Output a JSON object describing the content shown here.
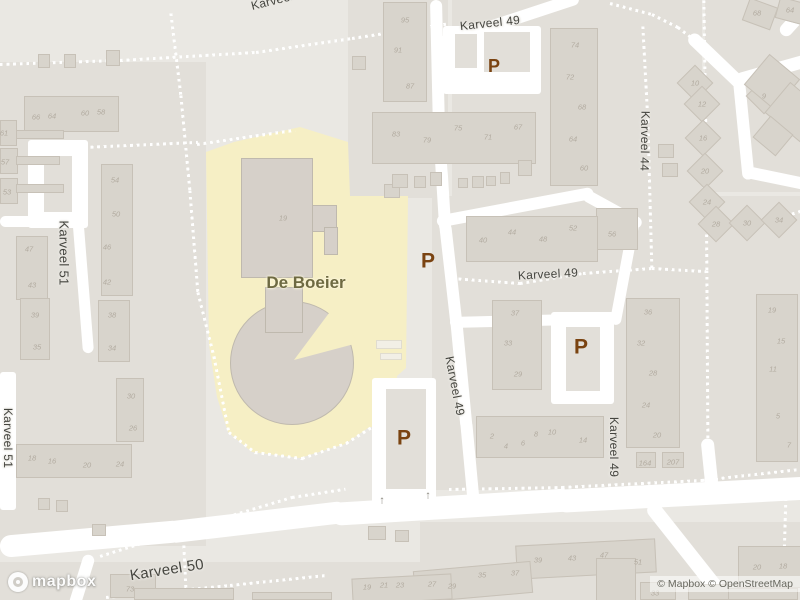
{
  "colors": {
    "base": "#eae8e3",
    "block": "#e2dfd9",
    "road": "#ffffff",
    "building_fill": "#d8d4cc",
    "building_stroke": "#c7c1b7",
    "school_fill": "#d6d0c9",
    "school_stroke": "#bfb9ae",
    "school_ground": "#f6efc5",
    "house_number": "#b2aba0",
    "street_label": "#45453f",
    "parking": "#7a4311",
    "poi_label": "#6e6a42"
  },
  "map": {
    "blocks": [
      [
        0,
        62,
        206,
        484
      ],
      [
        348,
        0,
        100,
        198
      ],
      [
        452,
        0,
        250,
        196
      ],
      [
        432,
        196,
        368,
        294
      ],
      [
        705,
        0,
        95,
        192
      ],
      [
        0,
        562,
        424,
        38
      ],
      [
        420,
        522,
        380,
        78
      ]
    ],
    "yellow_polygon": "206,152 234,142 300,127 348,142 350,196 408,196 406,368 397,376 395,420 368,428 345,444 300,458 252,452 228,432 217,397 209,345",
    "road_rects": [
      [
        28,
        140,
        60,
        88
      ],
      [
        0,
        372,
        16,
        138
      ],
      [
        551,
        312,
        63,
        92
      ],
      [
        372,
        378,
        64,
        133
      ],
      [
        443,
        26,
        98,
        68
      ]
    ],
    "islands": [
      [
        44,
        156,
        28,
        56
      ],
      [
        566,
        327,
        34,
        64
      ],
      [
        386,
        389,
        40,
        100
      ],
      [
        455,
        34,
        22,
        34
      ],
      [
        484,
        32,
        46,
        40
      ]
    ],
    "roads": [
      [
        0,
        221,
        36,
        221,
        11
      ],
      [
        78,
        220,
        88,
        346,
        11
      ],
      [
        0,
        547,
        170,
        532,
        22
      ],
      [
        165,
        533,
        335,
        513,
        22
      ],
      [
        330,
        514,
        560,
        500,
        23
      ],
      [
        555,
        501,
        800,
        488,
        23
      ],
      [
        650,
        504,
        726,
        600,
        15
      ],
      [
        90,
        555,
        76,
        600,
        12
      ],
      [
        436,
        0,
        439,
        130,
        12
      ],
      [
        439,
        128,
        445,
        225,
        12
      ],
      [
        445,
        223,
        456,
        320,
        12
      ],
      [
        456,
        318,
        466,
        422,
        12
      ],
      [
        466,
        420,
        473,
        495,
        12
      ],
      [
        438,
        44,
        572,
        0,
        12
      ],
      [
        437,
        222,
        586,
        194,
        12
      ],
      [
        584,
        194,
        635,
        222,
        12
      ],
      [
        634,
        222,
        616,
        318,
        11
      ],
      [
        450,
        322,
        614,
        318,
        11
      ],
      [
        690,
        35,
        738,
        81,
        13
      ],
      [
        736,
        80,
        800,
        62,
        13
      ],
      [
        739,
        81,
        748,
        172,
        12
      ],
      [
        747,
        172,
        800,
        183,
        12
      ],
      [
        707,
        438,
        713,
        496,
        13
      ],
      [
        782,
        34,
        800,
        14,
        13
      ]
    ],
    "foot_paths": [
      [
        0,
        64,
        120,
        60
      ],
      [
        120,
        60,
        256,
        52
      ],
      [
        256,
        52,
        352,
        38
      ],
      [
        352,
        38,
        444,
        24
      ],
      [
        171,
        13,
        181,
        95
      ],
      [
        181,
        95,
        190,
        190
      ],
      [
        190,
        190,
        198,
        292
      ],
      [
        198,
        292,
        214,
        356
      ],
      [
        214,
        356,
        229,
        432
      ],
      [
        229,
        432,
        255,
        452
      ],
      [
        255,
        452,
        302,
        458
      ],
      [
        302,
        458,
        346,
        443
      ],
      [
        346,
        443,
        370,
        428
      ],
      [
        84,
        147,
        196,
        142
      ],
      [
        197,
        144,
        293,
        130
      ],
      [
        452,
        278,
        520,
        283
      ],
      [
        520,
        283,
        583,
        273
      ],
      [
        583,
        273,
        652,
        268
      ],
      [
        652,
        268,
        704,
        271
      ],
      [
        643,
        26,
        648,
        120
      ],
      [
        648,
        120,
        652,
        268
      ],
      [
        704,
        0,
        706,
        135
      ],
      [
        706,
        135,
        707,
        270
      ],
      [
        707,
        270,
        708,
        436
      ],
      [
        449,
        489,
        562,
        487
      ],
      [
        562,
        487,
        702,
        480
      ],
      [
        702,
        480,
        800,
        469
      ],
      [
        100,
        556,
        202,
        524
      ],
      [
        202,
        524,
        292,
        497
      ],
      [
        292,
        497,
        344,
        489
      ],
      [
        186,
        594,
        183,
        530
      ],
      [
        106,
        597,
        230,
        585
      ],
      [
        230,
        585,
        326,
        575
      ],
      [
        786,
        498,
        783,
        600
      ],
      [
        748,
        228,
        800,
        211
      ],
      [
        610,
        3,
        652,
        14
      ],
      [
        652,
        14,
        678,
        27
      ],
      [
        678,
        27,
        691,
        37
      ]
    ],
    "school": {
      "circle": [
        292,
        363,
        62
      ],
      "wedge": "294,360 335,305 358,343",
      "rects": [
        [
          241,
          158,
          72,
          120
        ],
        [
          312,
          205,
          25,
          27
        ],
        [
          324,
          227,
          14,
          28
        ],
        [
          265,
          287,
          38,
          46
        ]
      ],
      "courts": [
        [
          376,
          340,
          26,
          9
        ],
        [
          380,
          353,
          22,
          7
        ]
      ]
    },
    "buildings": [
      [
        24,
        96,
        95,
        36
      ],
      [
        38,
        54,
        12,
        14
      ],
      [
        64,
        54,
        12,
        14
      ],
      [
        106,
        50,
        14,
        16
      ],
      [
        0,
        120,
        17,
        26
      ],
      [
        0,
        148,
        18,
        26
      ],
      [
        0,
        178,
        18,
        26
      ],
      [
        16,
        130,
        48,
        9
      ],
      [
        16,
        156,
        44,
        9
      ],
      [
        16,
        184,
        48,
        9
      ],
      [
        101,
        164,
        32,
        132
      ],
      [
        16,
        236,
        32,
        64
      ],
      [
        20,
        298,
        30,
        62
      ],
      [
        98,
        300,
        32,
        62
      ],
      [
        116,
        378,
        28,
        64
      ],
      [
        16,
        444,
        116,
        34
      ],
      [
        110,
        574,
        46,
        24
      ],
      [
        38,
        498,
        12,
        12
      ],
      [
        56,
        500,
        12,
        12
      ],
      [
        92,
        524,
        14,
        12
      ],
      [
        134,
        588,
        100,
        12
      ],
      [
        252,
        592,
        80,
        8
      ],
      [
        383,
        2,
        44,
        100
      ],
      [
        352,
        56,
        14,
        14
      ],
      [
        384,
        184,
        16,
        14
      ],
      [
        372,
        112,
        164,
        52
      ],
      [
        392,
        174,
        16,
        14
      ],
      [
        414,
        176,
        12,
        12
      ],
      [
        430,
        172,
        12,
        14
      ],
      [
        458,
        178,
        10,
        10
      ],
      [
        472,
        176,
        12,
        12
      ],
      [
        486,
        176,
        10,
        10
      ],
      [
        500,
        172,
        10,
        12
      ],
      [
        518,
        160,
        14,
        16
      ],
      [
        550,
        28,
        48,
        158
      ],
      [
        596,
        208,
        42,
        42
      ],
      [
        466,
        216,
        132,
        46
      ],
      [
        492,
        300,
        50,
        90
      ],
      [
        626,
        298,
        54,
        150
      ],
      [
        636,
        452,
        20,
        16
      ],
      [
        662,
        452,
        22,
        16
      ],
      [
        756,
        294,
        42,
        168
      ],
      [
        476,
        416,
        128,
        42
      ],
      [
        682,
        70,
        26,
        26,
        45
      ],
      [
        689,
        91,
        26,
        26,
        45
      ],
      [
        690,
        125,
        26,
        26,
        45
      ],
      [
        692,
        158,
        26,
        26,
        45
      ],
      [
        694,
        189,
        26,
        26,
        45
      ],
      [
        703,
        211,
        26,
        26,
        45
      ],
      [
        734,
        210,
        26,
        26,
        45
      ],
      [
        766,
        207,
        26,
        26,
        45
      ],
      [
        751,
        83,
        26,
        26,
        45
      ],
      [
        774,
        87,
        26,
        26,
        45
      ],
      [
        745,
        2,
        30,
        24,
        20
      ],
      [
        777,
        0,
        30,
        22,
        15
      ],
      [
        752,
        62,
        40,
        40,
        40
      ],
      [
        772,
        92,
        46,
        40,
        40
      ],
      [
        758,
        122,
        30,
        28,
        40
      ],
      [
        658,
        144,
        16,
        14
      ],
      [
        662,
        163,
        16,
        14
      ],
      [
        516,
        542,
        140,
        34,
        -3
      ],
      [
        596,
        558,
        40,
        44
      ],
      [
        414,
        566,
        118,
        32,
        -5
      ],
      [
        352,
        576,
        100,
        26,
        -3
      ],
      [
        738,
        546,
        64,
        42
      ],
      [
        640,
        582,
        36,
        18
      ],
      [
        688,
        584,
        50,
        16
      ],
      [
        728,
        588,
        70,
        12
      ],
      [
        368,
        526,
        18,
        14
      ],
      [
        395,
        530,
        14,
        12
      ]
    ],
    "house_numbers": [
      [
        "66",
        36,
        117
      ],
      [
        "64",
        52,
        116
      ],
      [
        "60",
        85,
        113
      ],
      [
        "58",
        101,
        112
      ],
      [
        "61",
        4,
        133
      ],
      [
        "57",
        5,
        162
      ],
      [
        "53",
        7,
        192
      ],
      [
        "54",
        115,
        180
      ],
      [
        "50",
        116,
        214
      ],
      [
        "46",
        107,
        247
      ],
      [
        "42",
        107,
        282
      ],
      [
        "47",
        29,
        249
      ],
      [
        "43",
        32,
        285
      ],
      [
        "39",
        35,
        315
      ],
      [
        "38",
        112,
        315
      ],
      [
        "35",
        37,
        347
      ],
      [
        "34",
        112,
        348
      ],
      [
        "30",
        131,
        396
      ],
      [
        "26",
        133,
        428
      ],
      [
        "18",
        32,
        458
      ],
      [
        "16",
        52,
        461
      ],
      [
        "20",
        87,
        465
      ],
      [
        "24",
        120,
        464
      ],
      [
        "73",
        130,
        589
      ],
      [
        "95",
        405,
        20
      ],
      [
        "91",
        398,
        50
      ],
      [
        "87",
        410,
        86
      ],
      [
        "83",
        396,
        134
      ],
      [
        "79",
        427,
        140
      ],
      [
        "75",
        458,
        128
      ],
      [
        "71",
        488,
        137
      ],
      [
        "67",
        518,
        127
      ],
      [
        "74",
        575,
        45
      ],
      [
        "72",
        570,
        77
      ],
      [
        "68",
        582,
        107
      ],
      [
        "64",
        573,
        139
      ],
      [
        "60",
        584,
        168
      ],
      [
        "40",
        483,
        240
      ],
      [
        "44",
        512,
        232
      ],
      [
        "48",
        543,
        239
      ],
      [
        "52",
        573,
        228
      ],
      [
        "56",
        612,
        234
      ],
      [
        "10",
        695,
        83
      ],
      [
        "12",
        702,
        104
      ],
      [
        "16",
        703,
        138
      ],
      [
        "20",
        705,
        171
      ],
      [
        "24",
        707,
        202
      ],
      [
        "28",
        716,
        224
      ],
      [
        "30",
        747,
        223
      ],
      [
        "34",
        779,
        220
      ],
      [
        "9",
        764,
        96
      ],
      [
        "68",
        757,
        13
      ],
      [
        "64",
        790,
        10
      ],
      [
        "37",
        515,
        313
      ],
      [
        "33",
        508,
        343
      ],
      [
        "29",
        518,
        374
      ],
      [
        "36",
        648,
        312
      ],
      [
        "32",
        641,
        343
      ],
      [
        "28",
        653,
        373
      ],
      [
        "24",
        646,
        405
      ],
      [
        "20",
        657,
        435
      ],
      [
        "164",
        645,
        463
      ],
      [
        "207",
        673,
        462
      ],
      [
        "19",
        772,
        310
      ],
      [
        "15",
        781,
        341
      ],
      [
        "11",
        773,
        369
      ],
      [
        "5",
        778,
        416
      ],
      [
        "7",
        789,
        445
      ],
      [
        "2",
        492,
        436
      ],
      [
        "4",
        506,
        446
      ],
      [
        "6",
        523,
        443
      ],
      [
        "8",
        536,
        434
      ],
      [
        "10",
        552,
        432
      ],
      [
        "14",
        583,
        440
      ],
      [
        "39",
        538,
        560
      ],
      [
        "43",
        572,
        558
      ],
      [
        "47",
        604,
        555
      ],
      [
        "51",
        638,
        562
      ],
      [
        "37",
        515,
        573
      ],
      [
        "35",
        482,
        575
      ],
      [
        "29",
        452,
        586
      ],
      [
        "27",
        432,
        584
      ],
      [
        "23",
        400,
        585
      ],
      [
        "21",
        384,
        585
      ],
      [
        "19",
        367,
        587
      ],
      [
        "33",
        655,
        593
      ],
      [
        "20",
        757,
        567
      ],
      [
        "18",
        783,
        566
      ],
      [
        "19",
        283,
        218
      ]
    ],
    "street_labels": [
      [
        "Karveel 49",
        490,
        23,
        -6,
        12
      ],
      [
        "Karveel 49",
        548,
        274,
        -3,
        12
      ],
      [
        "Karveel 50",
        167,
        570,
        -9,
        15
      ],
      [
        "Karveel 51",
        64,
        253,
        90,
        13
      ],
      [
        "Karveel 51",
        8,
        438,
        90,
        12
      ],
      [
        "Karveel 44",
        645,
        141,
        91,
        12
      ],
      [
        "Karveel 49",
        455,
        386,
        79,
        12
      ],
      [
        "Karveel 49",
        614,
        447,
        90,
        12
      ],
      [
        "Karveel",
        272,
        1,
        -14,
        12
      ]
    ],
    "poi": {
      "label": "De Boeier",
      "x": 306,
      "y": 283,
      "size": 17
    },
    "parking_glyph": "P",
    "parking_markers": [
      [
        494,
        66,
        18
      ],
      [
        428,
        261,
        21
      ],
      [
        581,
        347,
        21
      ],
      [
        404,
        438,
        21
      ]
    ],
    "arrow_glyph": "↑",
    "arrows": [
      [
        382,
        501
      ],
      [
        428,
        496
      ]
    ]
  },
  "footer": {
    "logo_text": "mapbox",
    "attribution": "© Mapbox © OpenStreetMap"
  }
}
